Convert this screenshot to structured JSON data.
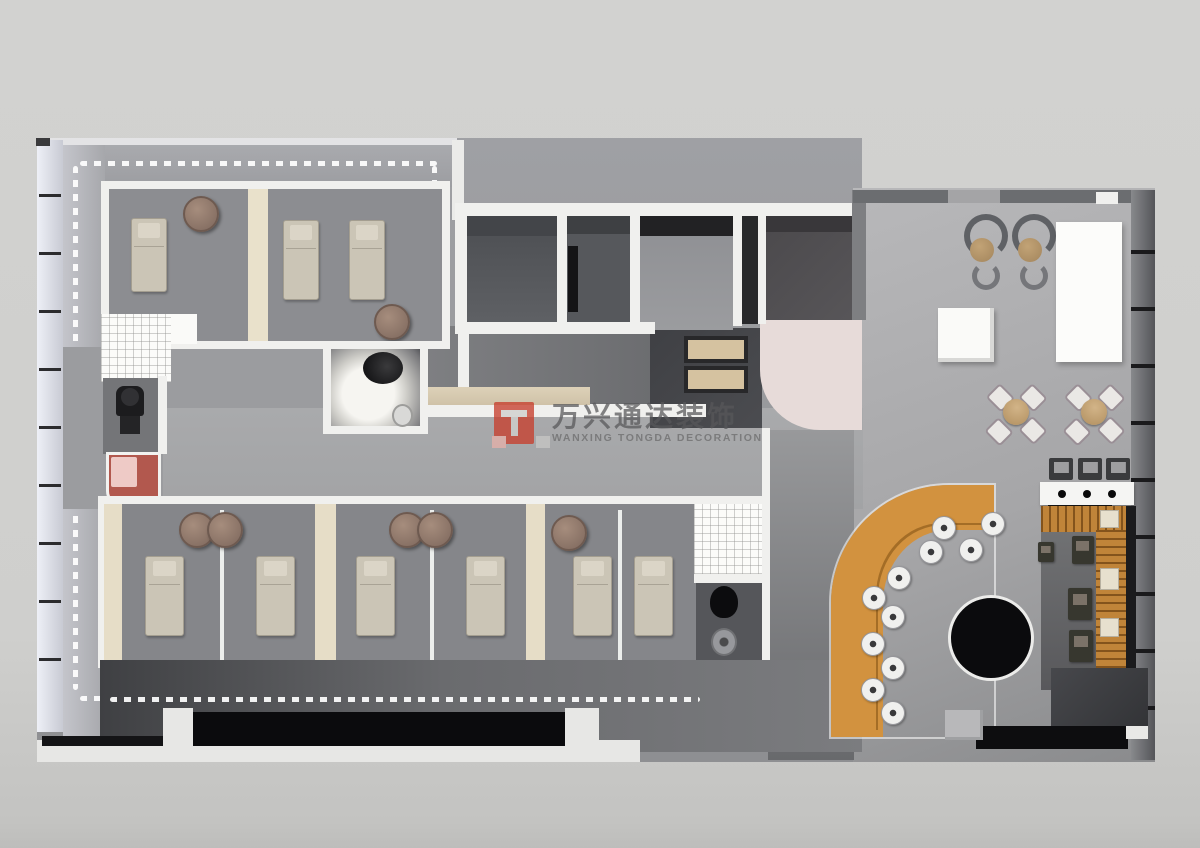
{
  "watermark": {
    "title_cn": "万兴通达装饰",
    "subtitle_en": "WANXING TONGDA DECORATION"
  },
  "palette": {
    "bg": "#d0d0ce",
    "wall": "#f0f0ee",
    "floor-light": "#b3b3b5",
    "floor-mid": "#98999c",
    "floor-dark": "#5c5d60",
    "room-dark": "#55575b",
    "bed": "#cbc5b6",
    "bed-border": "#a49e90",
    "stool": "#8d7569",
    "sofa": "#d2923f",
    "wood": "#c08439",
    "pink-counter": "#e7dbd9",
    "red-desk": "#b2584e",
    "pink-desk": "#eecac6",
    "black": "#121214",
    "led": "#ffffff",
    "watermark-red": "#c7402e",
    "watermark-text": "#6d6d6f"
  },
  "scene": {
    "type": "3d-rendered floor plan (spa / beauty salon office)",
    "areas": [
      "treatment-rooms-top",
      "utility-rooms",
      "spotlight-bathroom",
      "corridor",
      "reception-pink-counter",
      "lounge-dining",
      "bar",
      "curved-booth-seating",
      "treatment-rooms-bottom",
      "restroom",
      "stage"
    ]
  }
}
